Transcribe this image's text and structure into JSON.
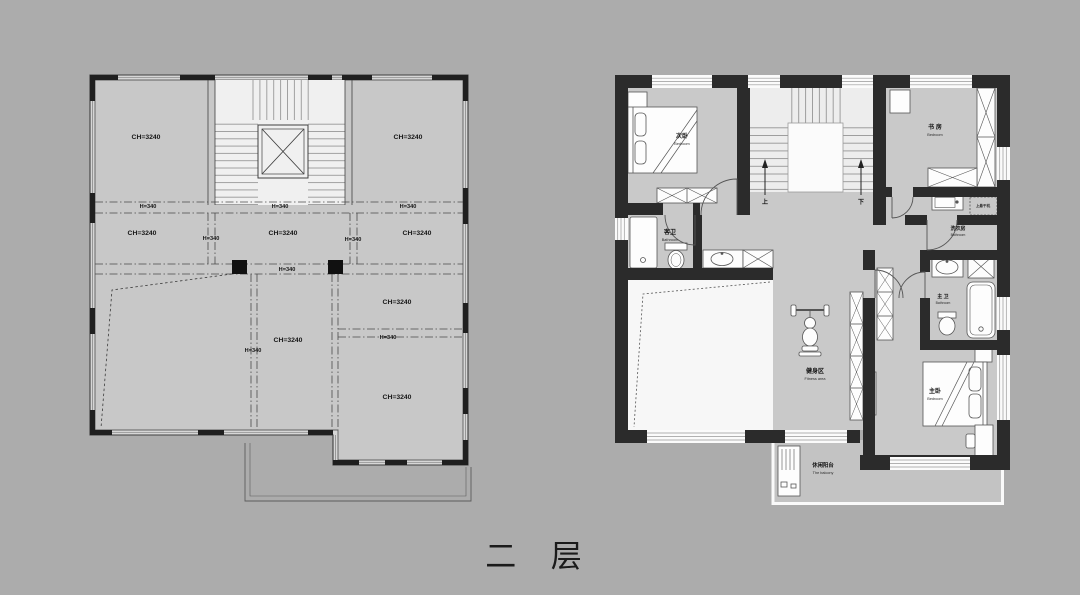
{
  "page": {
    "title": "二 层"
  },
  "colors": {
    "background": "#acacac",
    "floor": "#c9c9c9",
    "wall": "#2b2b2b",
    "void_area": "#f7f7f7",
    "balcony": "#c3c3c3",
    "line": "#3f3f3f"
  },
  "left_plan": {
    "ceiling_height_label": "CH=3240",
    "beam_height_label": "H=340"
  },
  "right_plan": {
    "rooms": {
      "secondary_bedroom": {
        "zh": "次卧",
        "en": "Bedroom"
      },
      "study": {
        "zh": "书 房",
        "en": "Bedroom"
      },
      "guest_bathroom": {
        "zh": "客卫",
        "en": "Bathroom"
      },
      "laundry": {
        "zh": "洗衣房",
        "en": "Bathroom"
      },
      "dryer_note": "上悬干机",
      "master_bathroom": {
        "zh": "主 卫",
        "en": "Bathroom"
      },
      "master_bedroom": {
        "zh": "主卧",
        "en": "Bedroom"
      },
      "fitness_area": {
        "zh": "健身区",
        "en": "Fitness area"
      },
      "leisure_balcony": {
        "zh": "休闲阳台",
        "en": "The balcony"
      }
    },
    "stairs": {
      "up_label": "上",
      "down_label": "下"
    }
  }
}
